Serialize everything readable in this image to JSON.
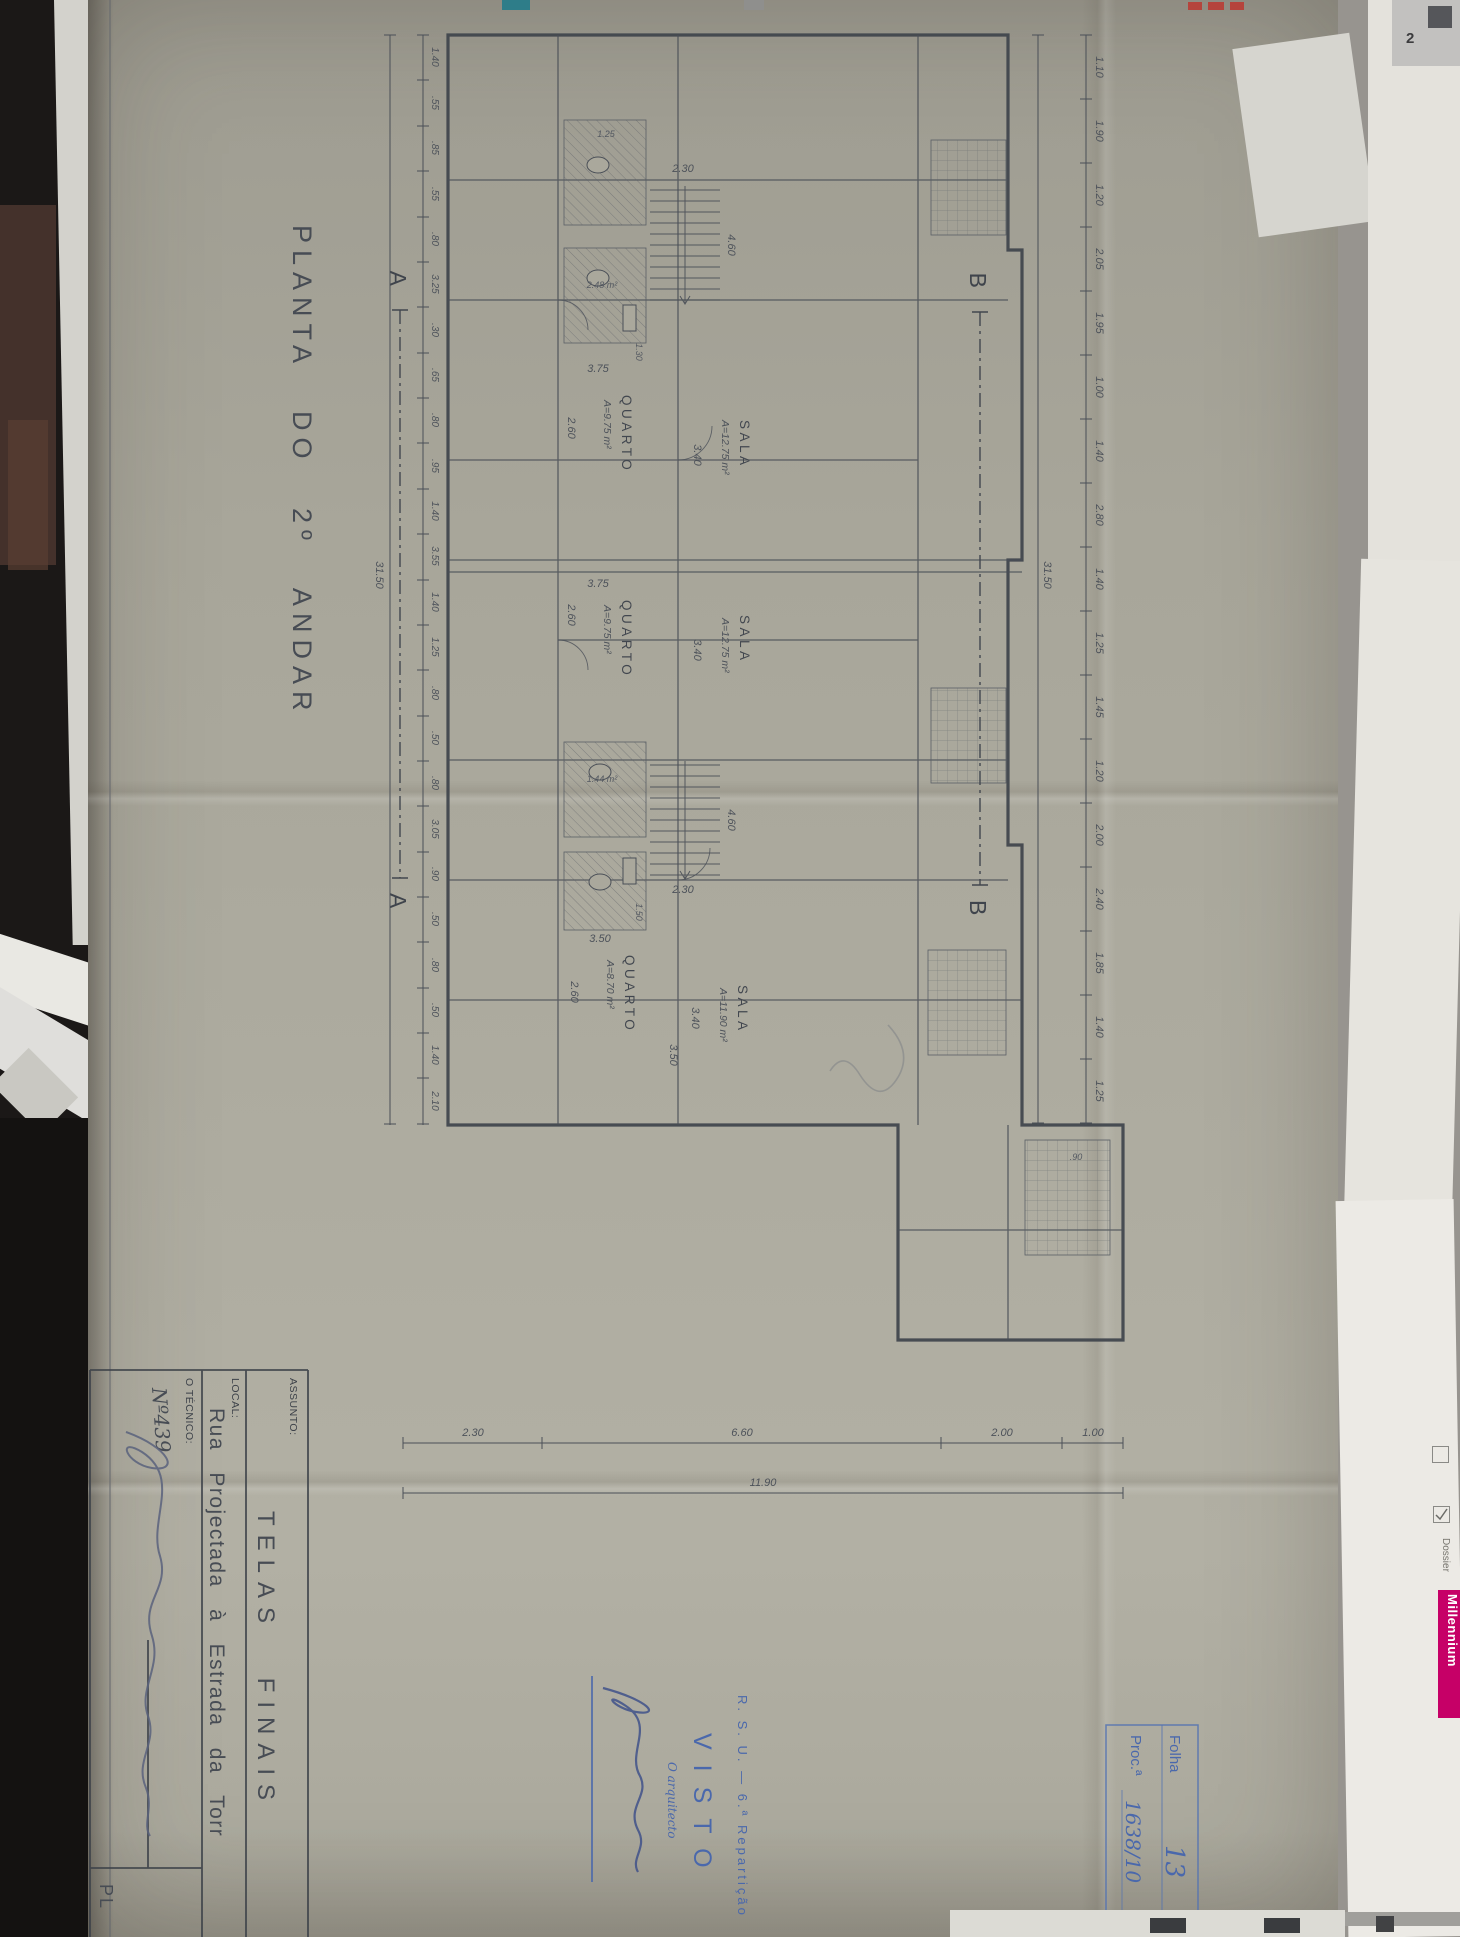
{
  "colors": {
    "paper": "#aaa89c",
    "ink": "#474c54",
    "stamp_blue": "#4a68ac",
    "pencil_blue": "#59627c",
    "brand_magenta": "#c60067"
  },
  "sheet": {
    "title": "PLANTA DO 2º ANDAR",
    "title_block": {
      "assunto_label": "ASSUNTO:",
      "assunto_value": "TELAS FINAIS",
      "local_label": "LOCAL:",
      "local_value": "Rua Projectada à Estrada da Torr",
      "tecnico_label": "O TÉCNICO:",
      "tecnico_number": "Nº439",
      "sheet_code": "PL"
    },
    "corner_stamp": {
      "folha_label": "Folha",
      "folha_value": "13",
      "proc_label": "Proc.ª",
      "proc_value": "1638/10"
    },
    "visto_stamp": {
      "department": "R. S. U. — 6.ª Repartição",
      "visto": "VISTO",
      "role": "O arquitecto"
    }
  },
  "plan": {
    "rooms": [
      {
        "name": "QUARTO",
        "area": "A=9.75 m²",
        "w": "2.60",
        "d": "3.75"
      },
      {
        "name": "SALA",
        "area": "A=12.75 m²",
        "w": "3.40",
        "d": "3.75"
      },
      {
        "name": "QUARTO",
        "area": "A=9.75 m²",
        "w": "2.60",
        "d": "3.75"
      },
      {
        "name": "SALA",
        "area": "A=12.75 m²",
        "w": "3.40",
        "d": "3.75"
      },
      {
        "name": "QUARTO",
        "area": "A=8.70 m²",
        "w": "2.60",
        "d": "3.50"
      },
      {
        "name": "SALA",
        "area": "A=11.90 m²",
        "w": "3.40",
        "d": "3.50"
      }
    ],
    "stairs": {
      "length": "4.60",
      "width": "2.30"
    },
    "section_a": "A",
    "section_b": "B",
    "chains": {
      "top": {
        "values": [
          "1.10",
          "1.90",
          "1.20",
          "2.05",
          "1.95",
          "1.00",
          "1.40",
          "2.80",
          "1.40",
          "1.25",
          "1.45",
          "1.20",
          "2.00",
          "2.40",
          "1.85",
          "1.40",
          "1.25"
        ],
        "total": "31.50"
      },
      "bottom": {
        "values": [
          "1.40",
          ".55",
          ".85",
          ".55",
          ".80",
          "3.25",
          ".30",
          ".65",
          ".80",
          ".95",
          "1.40",
          "3.55",
          "1.40",
          "1.25",
          ".80",
          ".50",
          ".80",
          "3.05",
          ".90",
          ".50",
          ".80",
          ".50",
          "1.40",
          "2.10"
        ],
        "total": "31.50"
      },
      "right": {
        "values": [
          "1.00",
          "2.00",
          "6.60",
          "2.30"
        ],
        "total": "11.90"
      }
    },
    "small_dims": {
      "a": "1.25",
      "b": "2.48 m²",
      "c": "1.30",
      "d": "1.44 m²",
      "e": "1.50",
      "f": ".90"
    }
  },
  "surround": {
    "brand": "Millennium",
    "dossier": "Dossier",
    "corner_number": "2"
  }
}
